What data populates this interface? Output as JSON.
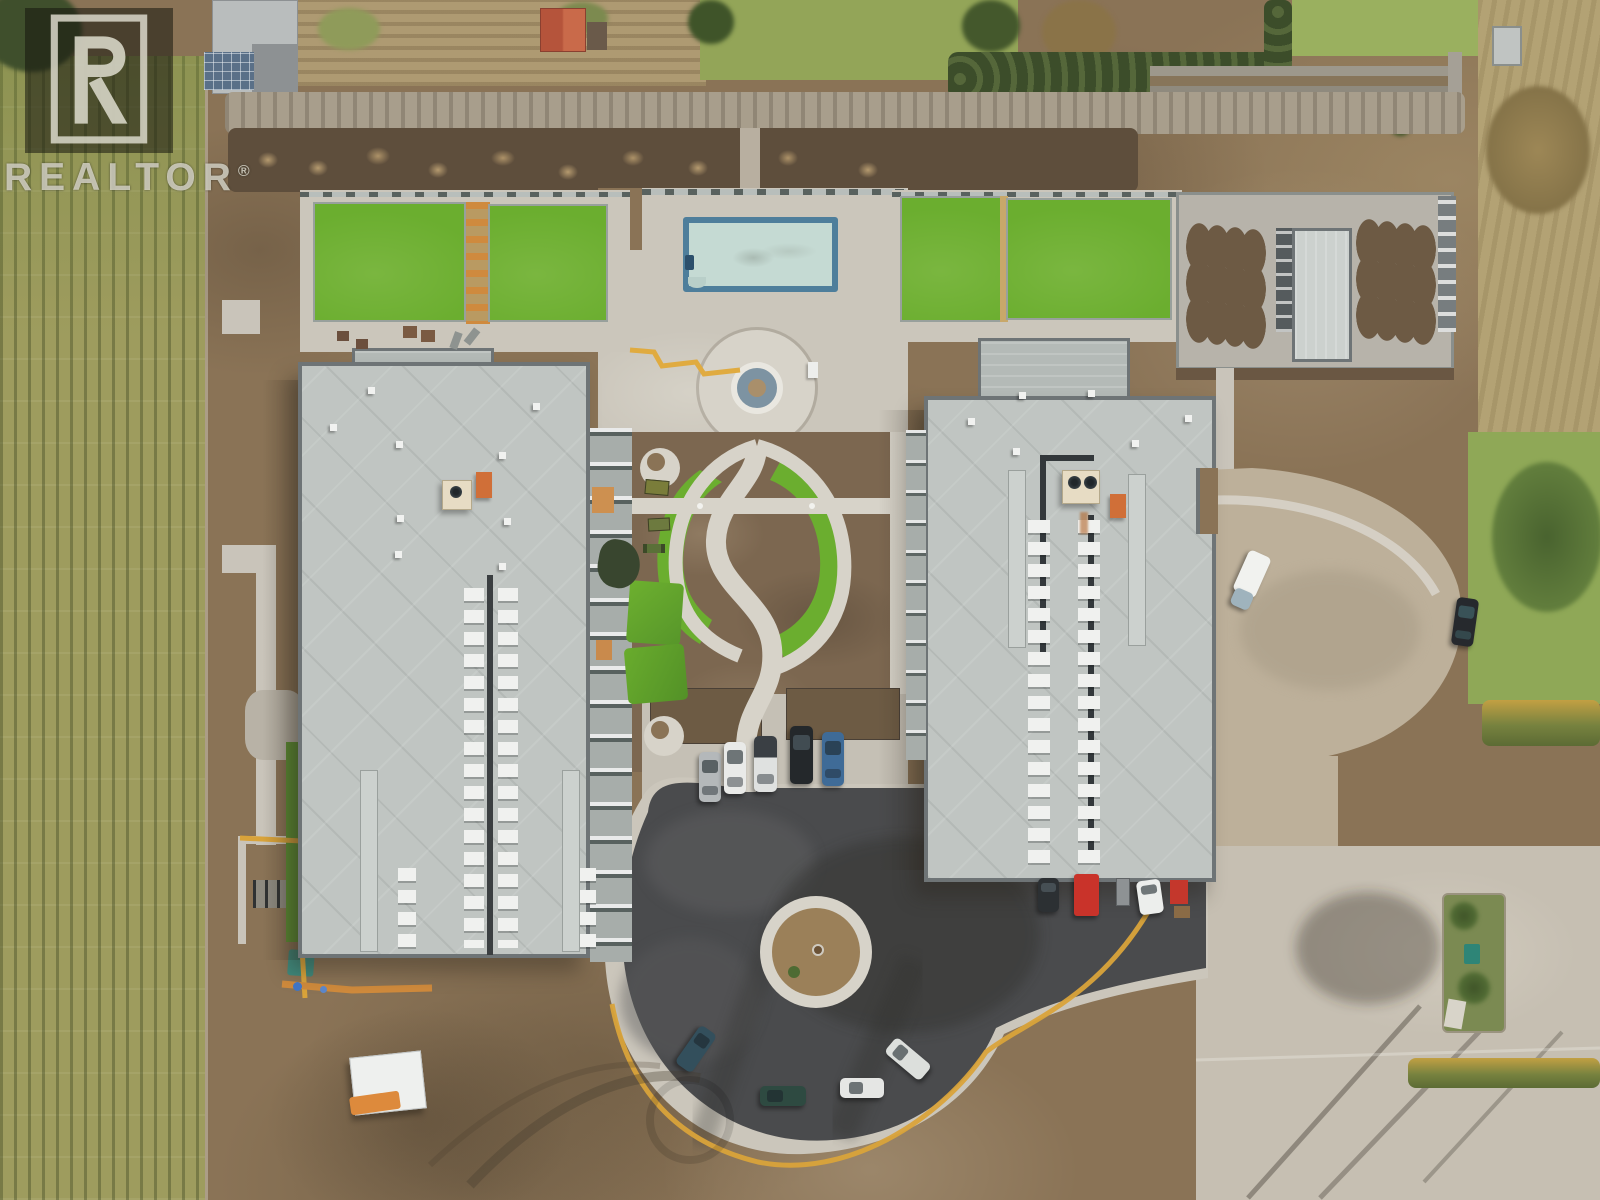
{
  "watermark": {
    "brand": "REALTOR",
    "reg": "®",
    "logo_letter": "R"
  },
  "scene": {
    "description": "Aerial drone view of a newly built two-building residential complex under construction, with pool courtyard, looped garden paths, roundabout driveway, rooftop HVAC units, amenity lawn decks, vineyard and neighboring gardens",
    "features": [
      "vineyard-rows",
      "neighbor-gardens",
      "hedge-row",
      "pool",
      "fountain-plaza",
      "garden-loop-paths",
      "turf-crescents",
      "roundabout",
      "center-island",
      "parking-row",
      "amenity-lawn-deck",
      "planter-deck",
      "rooftop-hvac",
      "construction-dirt",
      "silt-fence",
      "white-trailer",
      "cargo-van",
      "loading-vehicles"
    ]
  },
  "colors": {
    "dirt": "#8a7356",
    "dirt_dark": "#5e4e3c",
    "dirt_light": "#9c8866",
    "gravel": "#a89e8c",
    "vineyard": "#9e9c5e",
    "vineyard_row": "#7f854c",
    "turf": "#6bae2f",
    "turf_dark": "#5d9333",
    "lawn": "#8fa857",
    "hedge": "#46552f",
    "concrete": "#cbc6bb",
    "path": "#d7d3c9",
    "road_tan": "#bdb09a",
    "pavement": "#c6bfb2",
    "roof": "#c0c5c2",
    "roof_wing": "#b4bab7",
    "roof_edge": "#6e7476",
    "walkway": "#ccd1ce",
    "penthouse": "#e7dcc4",
    "asphalt": "#4a4b4d",
    "pool_rim": "#4e7e9b",
    "pool_water": "#c5dad3",
    "orange": "#d06f38",
    "red": "#c9332a",
    "yellow": "#d9a33a",
    "white_unit": "#f0f1ef",
    "wm_bg": "rgba(22,22,14,0.55)",
    "wm_fg": "rgba(225,223,210,0.78)"
  }
}
